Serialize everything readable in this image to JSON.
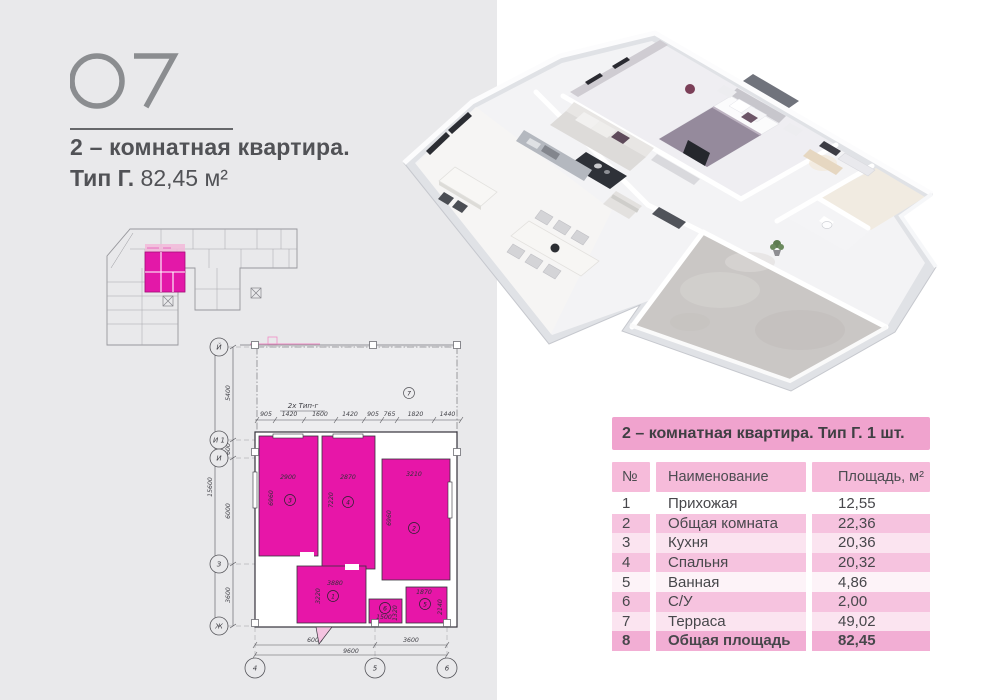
{
  "page": {
    "number": "07",
    "title_line1": "2 – комнатная квартира.",
    "title_line2_bold": "Тип Г.",
    "title_line2_value": "82,45 м²"
  },
  "colors": {
    "accent_magenta": "#e716a8",
    "table_header_pink": "#f0a3ce",
    "table_subheader_pink": "#f6bbda",
    "row_pink": "#f6c3df",
    "left_panel_gray": "#e9e9eb"
  },
  "table": {
    "title": "2 – комнатная квартира. Тип Г. 1 шт.",
    "columns": [
      "№",
      "Наименование",
      "Площадь, м²"
    ],
    "rows": [
      {
        "num": "1",
        "name": "Прихожая",
        "area": "12,55"
      },
      {
        "num": "2",
        "name": "Общая комната",
        "area": "22,36"
      },
      {
        "num": "3",
        "name": "Кухня",
        "area": "20,36"
      },
      {
        "num": "4",
        "name": "Спальня",
        "area": "20,32"
      },
      {
        "num": "5",
        "name": "Ванная",
        "area": "4,86"
      },
      {
        "num": "6",
        "name": "С/У",
        "area": "2,00"
      },
      {
        "num": "7",
        "name": "Терраса",
        "area": "49,02"
      },
      {
        "num": "8",
        "name": "Общая площадь",
        "area": "82,45"
      }
    ]
  },
  "plan": {
    "type_label": "2x Тип-г",
    "axes_left": [
      "Й",
      "И 1",
      "И",
      "З",
      "Ж"
    ],
    "axes_bottom": [
      "4",
      "5",
      "6"
    ],
    "top_dims": [
      "905",
      "1420",
      "1600",
      "1420",
      "905",
      "765",
      "1820",
      "1440"
    ],
    "left_dims": {
      "d1": "5400",
      "d2": "600",
      "d3": "6000",
      "d4": "3600",
      "total": "15600"
    },
    "bottom_dims": {
      "d1": "6000",
      "d2": "3600",
      "total": "9600"
    },
    "rooms": [
      {
        "n": "1",
        "dim_w": "3880",
        "dim_h": "3220"
      },
      {
        "n": "2",
        "dim_w": "3210",
        "dim_h": "6960"
      },
      {
        "n": "3",
        "dim_w": "2900",
        "dim_h": "6960"
      },
      {
        "n": "4",
        "dim_w": "2870",
        "dim_h": "7220"
      },
      {
        "n": "5",
        "dim_w": "1870",
        "dim_h": "2140"
      },
      {
        "n": "6",
        "dim_w": "1500",
        "dim_h": "1320"
      },
      {
        "n": "7"
      }
    ]
  }
}
